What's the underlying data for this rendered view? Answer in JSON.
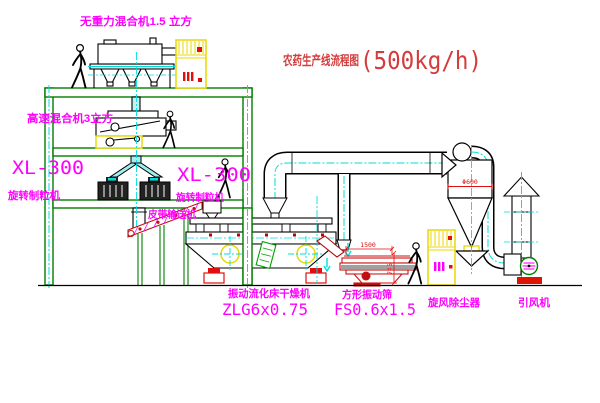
{
  "title": {
    "text": "农药生产线流程图",
    "capacity": "(500kg/h)"
  },
  "labels": {
    "gravity_mixer": "无重力混合机1.5 立方",
    "high_speed_mixer": "高速混合机3立方",
    "granulator_left_model": "XL-300",
    "granulator_left_name": "旋转制粒机",
    "granulator_mid_model": "XL-300",
    "granulator_mid_name": "旋转制粒机",
    "belt_conveyor": "皮带输送机",
    "dryer_name": "振动流化床干燥机",
    "dryer_model": "ZLG6x0.75",
    "screen_name": "方形振动筛",
    "screen_model": "FS0.6x1.5",
    "cyclone_name": "旋风除尘器",
    "fan_name": "引风机"
  },
  "dimensions": {
    "screen_length": "1500",
    "screen_height": "745",
    "cyclone_diameter": "Φ600"
  },
  "colors": {
    "label_magenta": "#ff00ff",
    "title_red": "#d43c3c",
    "structure_green": "#007d00",
    "centerline_cyan": "#00dede",
    "cabinet_yellow": "#e8d800",
    "alert_red": "#e01010"
  }
}
